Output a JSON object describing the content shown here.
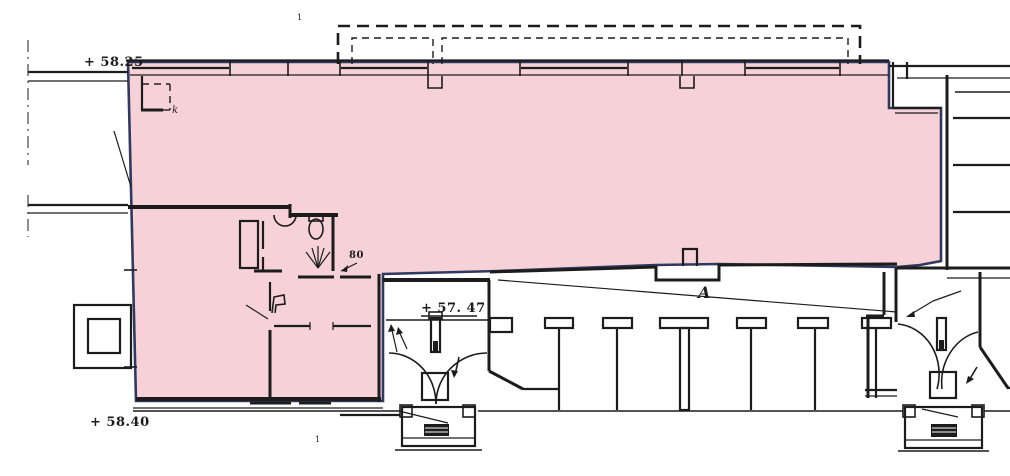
{
  "plan": {
    "labels": {
      "elevation_top_left": "+ 58.25",
      "elevation_bottom_left": "+ 58.40",
      "elevation_entrance": "+ 57. 47",
      "dimension_wc": "80",
      "section_letter": "A",
      "room_mark": "k",
      "tick_top": "1",
      "tick_bottom": "1"
    },
    "colors": {
      "highlight_fill": "#f6d2d8",
      "highlight_outline": "#303a60",
      "ink": "#1c1c1c",
      "paper": "#ffffff"
    }
  }
}
